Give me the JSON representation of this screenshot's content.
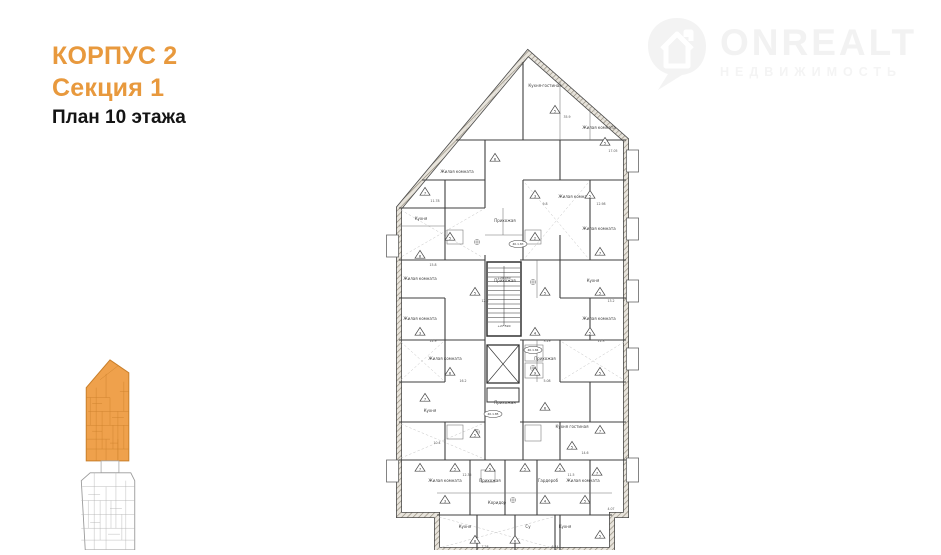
{
  "header": {
    "korpus": "КОРПУС 2",
    "sektsiya": "Секция 1",
    "plan_floor": "План 10 этажа",
    "accent_color": "#e8993d"
  },
  "logo": {
    "brand": "ONREALT",
    "tagline": "НЕДВИЖИМОСТЬ",
    "color": "#f2f2f2",
    "icon": "map-pin-house-icon"
  },
  "minimap": {
    "highlight_color": "#efa14c",
    "highlight_line_color": "#c97f2a",
    "inactive_line_color": "#a8a8a8"
  },
  "plan": {
    "line_color": "#3f3f3f",
    "wall_fill": "#e8e4dc",
    "wall_hatch": "#8f8878",
    "rooms": [
      {
        "x": 160,
        "y": 57,
        "t": "Кухня-гостиная"
      },
      {
        "x": 214,
        "y": 99,
        "t": "Жилая комната"
      },
      {
        "x": 72,
        "y": 143,
        "t": "Жилая комната"
      },
      {
        "x": 190,
        "y": 168,
        "t": "Жилая комната"
      },
      {
        "x": 36,
        "y": 190,
        "t": "Кухня"
      },
      {
        "x": 120,
        "y": 192,
        "t": "Прихожая"
      },
      {
        "x": 214,
        "y": 200,
        "t": "Жилая комната"
      },
      {
        "x": 35,
        "y": 250,
        "t": "Жилая комната"
      },
      {
        "x": 120,
        "y": 252,
        "t": "Прихожая"
      },
      {
        "x": 208,
        "y": 252,
        "t": "Кухня"
      },
      {
        "x": 35,
        "y": 290,
        "t": "Жилая комната"
      },
      {
        "x": 214,
        "y": 290,
        "t": "Жилая комната"
      },
      {
        "x": 60,
        "y": 330,
        "t": "Жилая комната"
      },
      {
        "x": 160,
        "y": 330,
        "t": "Прихожая"
      },
      {
        "x": 45,
        "y": 382,
        "t": "Кухня"
      },
      {
        "x": 120,
        "y": 374,
        "t": "Прихожая"
      },
      {
        "x": 187,
        "y": 398,
        "t": "Кухня гостиная"
      },
      {
        "x": 60,
        "y": 452,
        "t": "Жилая комната"
      },
      {
        "x": 105,
        "y": 452,
        "t": "Прихожая"
      },
      {
        "x": 163,
        "y": 452,
        "t": "Гардероб"
      },
      {
        "x": 198,
        "y": 452,
        "t": "Жилая комната"
      },
      {
        "x": 112,
        "y": 474,
        "t": "Коридор"
      },
      {
        "x": 80,
        "y": 498,
        "t": "Кухня"
      },
      {
        "x": 143,
        "y": 498,
        "t": "Су"
      },
      {
        "x": 180,
        "y": 498,
        "t": "Кухня"
      }
    ],
    "triangles": [
      {
        "x": 170,
        "y": 80,
        "n": "5"
      },
      {
        "x": 220,
        "y": 112,
        "n": "5"
      },
      {
        "x": 110,
        "y": 128,
        "n": "8"
      },
      {
        "x": 40,
        "y": 162,
        "n": "7"
      },
      {
        "x": 150,
        "y": 165,
        "n": "3"
      },
      {
        "x": 205,
        "y": 165,
        "n": "5"
      },
      {
        "x": 65,
        "y": 207,
        "n": "5"
      },
      {
        "x": 150,
        "y": 207,
        "n": "2"
      },
      {
        "x": 215,
        "y": 222,
        "n": "7"
      },
      {
        "x": 35,
        "y": 225,
        "n": "8"
      },
      {
        "x": 90,
        "y": 262,
        "n": "5"
      },
      {
        "x": 160,
        "y": 262,
        "n": "5"
      },
      {
        "x": 215,
        "y": 262,
        "n": "5"
      },
      {
        "x": 35,
        "y": 302,
        "n": "3"
      },
      {
        "x": 150,
        "y": 302,
        "n": "4"
      },
      {
        "x": 205,
        "y": 302,
        "n": "5"
      },
      {
        "x": 65,
        "y": 342,
        "n": "8"
      },
      {
        "x": 150,
        "y": 342,
        "n": "9"
      },
      {
        "x": 215,
        "y": 342,
        "n": "5"
      },
      {
        "x": 40,
        "y": 368,
        "n": "7"
      },
      {
        "x": 90,
        "y": 404,
        "n": "5"
      },
      {
        "x": 160,
        "y": 377,
        "n": "6"
      },
      {
        "x": 187,
        "y": 416,
        "n": "5"
      },
      {
        "x": 215,
        "y": 400,
        "n": "7"
      },
      {
        "x": 35,
        "y": 438,
        "n": "7"
      },
      {
        "x": 70,
        "y": 438,
        "n": "5"
      },
      {
        "x": 105,
        "y": 438,
        "n": "5"
      },
      {
        "x": 140,
        "y": 438,
        "n": "5"
      },
      {
        "x": 175,
        "y": 438,
        "n": "5"
      },
      {
        "x": 212,
        "y": 442,
        "n": "7"
      },
      {
        "x": 60,
        "y": 470,
        "n": "3"
      },
      {
        "x": 160,
        "y": 470,
        "n": "4"
      },
      {
        "x": 200,
        "y": 470,
        "n": "5"
      },
      {
        "x": 90,
        "y": 510,
        "n": "8"
      },
      {
        "x": 130,
        "y": 510,
        "n": "6"
      },
      {
        "x": 215,
        "y": 505,
        "n": "5"
      }
    ],
    "areas": [
      {
        "x": 182,
        "y": 88,
        "t": "35.9"
      },
      {
        "x": 228,
        "y": 122,
        "t": "17.05"
      },
      {
        "x": 50,
        "y": 172,
        "t": "11.78"
      },
      {
        "x": 160,
        "y": 175,
        "t": "9.8"
      },
      {
        "x": 216,
        "y": 175,
        "t": "12.98"
      },
      {
        "x": 48,
        "y": 236,
        "t": "15.8"
      },
      {
        "x": 100,
        "y": 272,
        "t": "12.5"
      },
      {
        "x": 226,
        "y": 272,
        "t": "13.2"
      },
      {
        "x": 48,
        "y": 312,
        "t": "12.9"
      },
      {
        "x": 162,
        "y": 312,
        "t": "3.29"
      },
      {
        "x": 216,
        "y": 312,
        "t": "11.3"
      },
      {
        "x": 78,
        "y": 352,
        "t": "16.2"
      },
      {
        "x": 162,
        "y": 352,
        "t": "5.08"
      },
      {
        "x": 52,
        "y": 414,
        "t": "10.4"
      },
      {
        "x": 200,
        "y": 424,
        "t": "14.6"
      },
      {
        "x": 82,
        "y": 446,
        "t": "12.35"
      },
      {
        "x": 186,
        "y": 446,
        "t": "11.5"
      },
      {
        "x": 100,
        "y": 518,
        "t": "7.28"
      },
      {
        "x": 170,
        "y": 518,
        "t": "6.44"
      },
      {
        "x": 226,
        "y": 480,
        "t": "4.07"
      }
    ],
    "stamps": [
      {
        "x": 133,
        "y": 214,
        "t": "40.1.83"
      },
      {
        "x": 148,
        "y": 320,
        "t": "40.1.84"
      },
      {
        "x": 108,
        "y": 384,
        "t": "40.1.85"
      }
    ],
    "elevations": [
      {
        "x": 119,
        "y": 249,
        "t": "+29.030"
      },
      {
        "x": 119,
        "y": 297,
        "t": "+27.590"
      }
    ]
  }
}
